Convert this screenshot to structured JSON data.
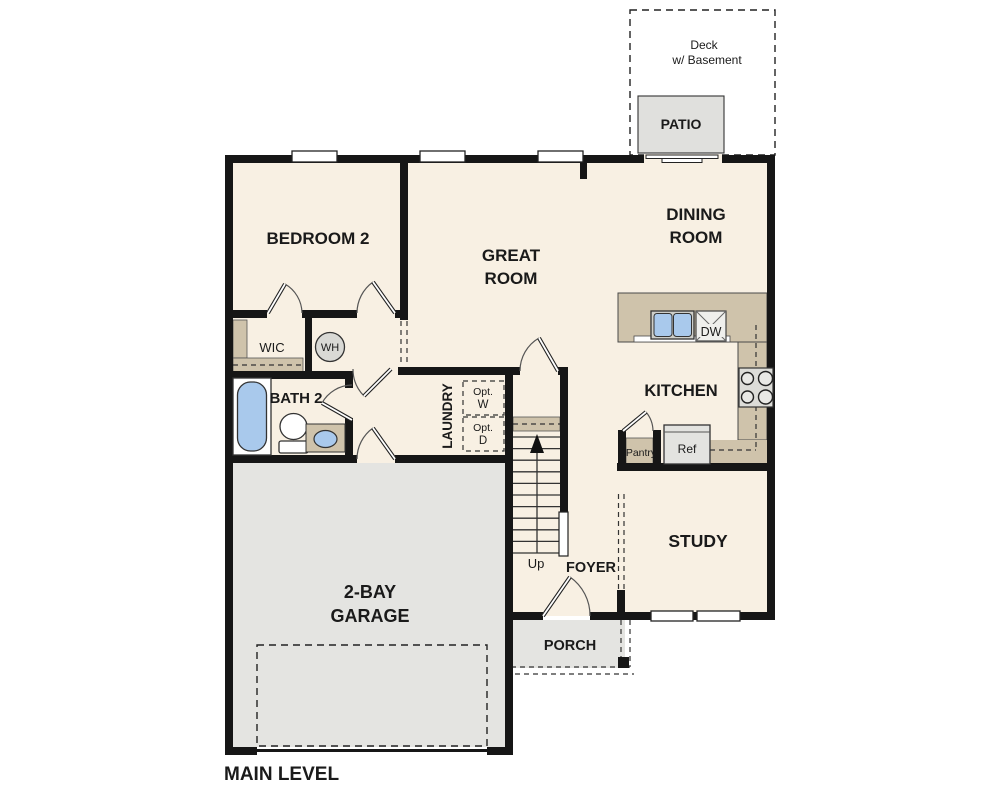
{
  "plan": {
    "title": "MAIN LEVEL",
    "colors": {
      "wall": "#161616",
      "floor": "#f8f0e3",
      "exterior_concrete": "#e4e4e1",
      "counter_tan": "#cfc3ab",
      "fixture_blue": "#a9c9ec",
      "appliance_gray": "#dcdcd8"
    }
  },
  "rooms": {
    "bedroom2": {
      "label": "BEDROOM 2"
    },
    "great_room": {
      "line1": "GREAT",
      "line2": "ROOM"
    },
    "dining_room": {
      "line1": "DINING",
      "line2": "ROOM"
    },
    "kitchen": {
      "label": "KITCHEN"
    },
    "study": {
      "label": "STUDY"
    },
    "garage": {
      "line1": "2-BAY",
      "line2": "GARAGE"
    },
    "bath2": {
      "label": "BATH 2"
    },
    "wic": {
      "label": "WIC"
    },
    "laundry": {
      "label": "LAUNDRY"
    },
    "foyer": {
      "label": "FOYER"
    },
    "porch": {
      "label": "PORCH"
    },
    "patio": {
      "label": "PATIO"
    },
    "deck": {
      "line1": "Deck",
      "line2": "w/ Basement"
    }
  },
  "fixtures": {
    "water_heater": "WH",
    "dishwasher": "DW",
    "refrigerator": "Ref",
    "pantry": "Pantry",
    "optional_washer": {
      "line1": "Opt.",
      "line2": "W"
    },
    "optional_dryer": {
      "line1": "Opt.",
      "line2": "D"
    },
    "stairs_direction": "Up"
  }
}
